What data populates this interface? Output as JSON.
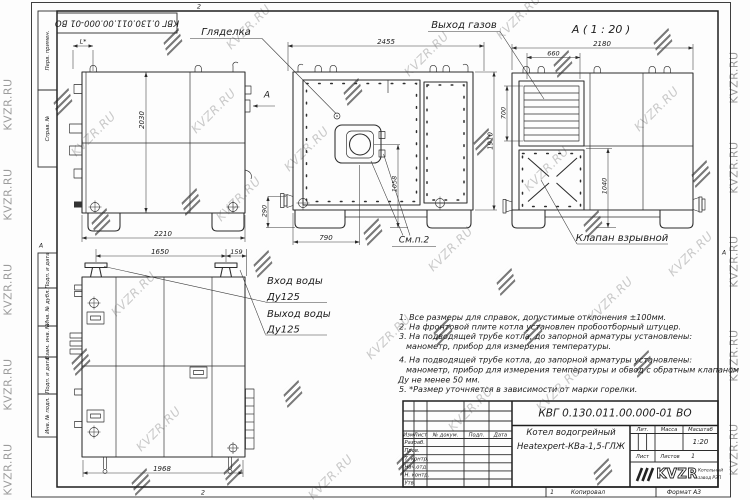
{
  "watermark": {
    "text": "KVZR.RU",
    "text_color": "#c9c9c9",
    "glyph_color": "#474747"
  },
  "frame": {
    "designation_rotated": "КВГ 0.130.011.00.000-01 ВО",
    "stamp": [
      "Перв. примен.",
      "Справ. №",
      "Подп. и дата",
      "Инв. № дубл.",
      "Взам. инв. №",
      "Подп. и дата",
      "Инв. № подл."
    ],
    "zone_left": "А",
    "zone_right": "А",
    "fold_top": "2",
    "fold_bottom": "2",
    "footer": {
      "sheet_no": "1",
      "copied": "Копировал",
      "format": "Формат А3"
    }
  },
  "views": {
    "side": {
      "dim_height": "2030",
      "dim_width": "2210",
      "dim_top": "L*",
      "arrow_label": "А"
    },
    "front": {
      "label_sight": "Гляделка",
      "label_gas": "Выход газов",
      "label_note": "См.п.2",
      "dim_top": "2455",
      "dim_height": "1910",
      "dim_burner": "1058",
      "dim_bottom": "790",
      "dim_flange": "290"
    },
    "section": {
      "title": "А ( 1 : 20 )",
      "label_valve": "Клапан взрывной",
      "dim_top": "2180",
      "dim_louver_w": "660",
      "dim_louver_h": "700",
      "dim_valve": "1040"
    },
    "plan": {
      "label_in1": "Вход воды",
      "label_in2": "Ду125",
      "label_out1": "Выход воды",
      "label_out2": "Ду125",
      "dim_top1": "1650",
      "dim_top2": "159",
      "dim_bottom": "1968"
    }
  },
  "notes": {
    "lines": [
      "1. Все размеры для справок, допустимые отклонения ±100мм.",
      "2. На фронтовой плите котла установлен пробоотборный штуцер.",
      "3. На подводящей трубе котла, до запорной арматуры установлены:",
      "манометр, прибор для измерения температуры.",
      "4. На подводящей трубе котла, до запорной арматуры установлены:",
      "манометр, прибор для измерения температуры и обвод с обратным клапаном",
      "Ду не менее 50 мм.",
      "5. *Размер уточняется в зависимости от марки горелки."
    ]
  },
  "title_block": {
    "designation": "КВГ 0.130.011.00.000-01 ВО",
    "name_line1": "Котел водогрейный",
    "name_line2": "Heatexpert-КВа-1,5-ГЛЖ",
    "cols": [
      "Изм",
      "Лист",
      "№ докум.",
      "Подп.",
      "Дата"
    ],
    "rows": [
      "Разраб.",
      "Пров.",
      "Т. контр.",
      "Нач.отд.",
      "Н. контр.",
      "Утв."
    ],
    "lit": "Лит.",
    "mass": "Масса",
    "scale": "Масштаб",
    "scale_value": "1:20",
    "sheet": "Лист",
    "sheets": "Листов",
    "sheets_value": "1",
    "logo": "KVZR",
    "logo_sub1": "Котельный",
    "logo_sub2": "завод РЭП"
  }
}
